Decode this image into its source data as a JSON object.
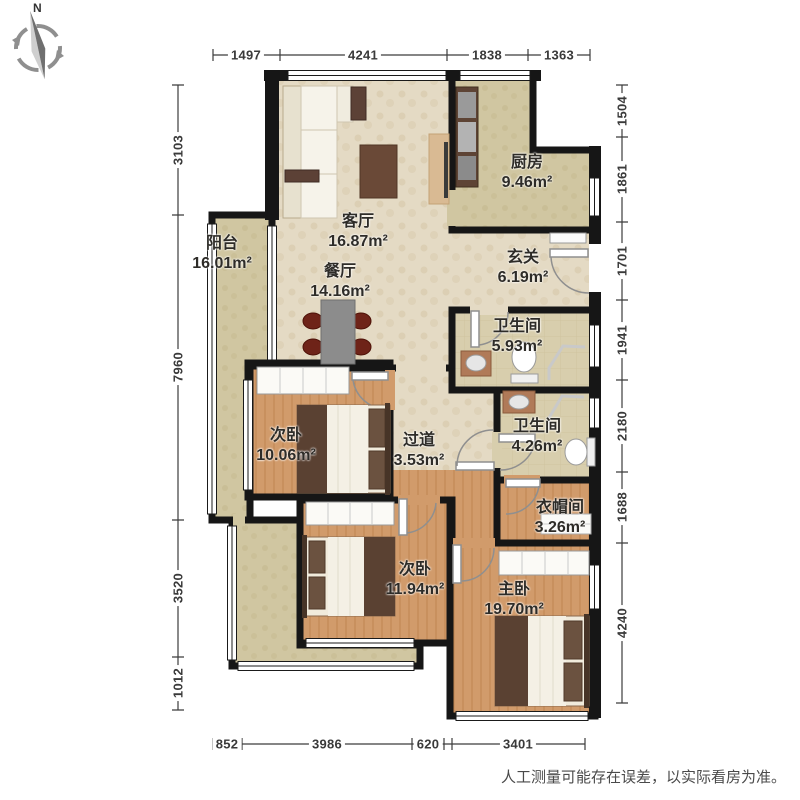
{
  "meta": {
    "compass_label": "N",
    "disclaimer": "人工测量可能存在误差，以实际看房为准。"
  },
  "rooms": [
    {
      "id": "living",
      "name": "客厅",
      "area": "16.87m²"
    },
    {
      "id": "dining",
      "name": "餐厅",
      "area": "14.16m²"
    },
    {
      "id": "kitchen",
      "name": "厨房",
      "area": "9.46m²"
    },
    {
      "id": "entry-hall",
      "name": "玄关",
      "area": "6.19m²"
    },
    {
      "id": "balcony",
      "name": "阳台",
      "area": "16.01m²"
    },
    {
      "id": "bathroom-1",
      "name": "卫生间",
      "area": "5.93m²"
    },
    {
      "id": "bathroom-2",
      "name": "卫生间",
      "area": "4.26m²"
    },
    {
      "id": "corridor",
      "name": "过道",
      "area": "3.53m²"
    },
    {
      "id": "bedroom-1",
      "name": "次卧",
      "area": "10.06m²"
    },
    {
      "id": "bedroom-2",
      "name": "次卧",
      "area": "11.94m²"
    },
    {
      "id": "cloakroom",
      "name": "衣帽间",
      "area": "3.26m²"
    },
    {
      "id": "master-bedroom",
      "name": "主卧",
      "area": "19.70m²"
    }
  ],
  "dimensions": {
    "top": [
      "1497",
      "4241",
      "1838",
      "1363"
    ],
    "bottom": [
      "852",
      "3986",
      "620",
      "3401"
    ],
    "left": [
      "3103",
      "7960",
      "3520",
      "1012"
    ],
    "right": [
      "1504",
      "1861",
      "1701",
      "1941",
      "2180",
      "1688",
      "4240"
    ]
  },
  "colors": {
    "wall": "#161616",
    "floor_wood": "#d19b6b",
    "floor_tile": "#e4dac4",
    "floor_balcony": "#d0c6a1",
    "furniture_accent": "#6e2318",
    "dimension_text": "#3a3a3a"
  }
}
